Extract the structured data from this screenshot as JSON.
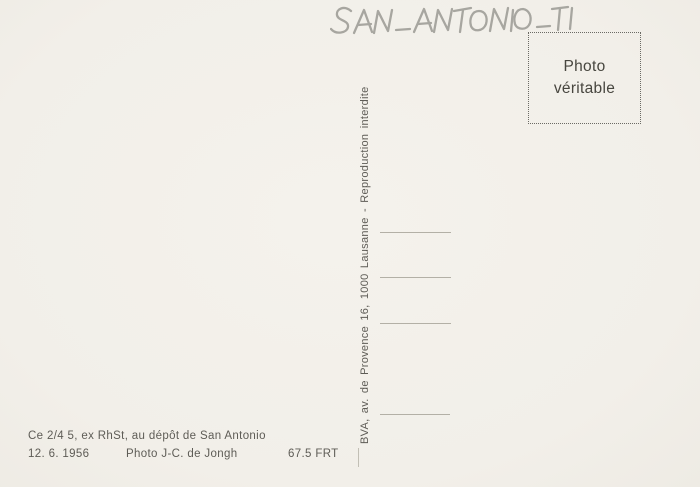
{
  "card": {
    "kind_label": "postcard back"
  },
  "handwriting": {
    "text": "SAN-ANTONIO-TI"
  },
  "stamp": {
    "line1": "Photo",
    "line2": "véritable"
  },
  "publisher": {
    "imprint": "BVA, av. de Provence 16, 1000 Lausanne - Reproduction interdite"
  },
  "caption": {
    "description": "Ce 2/4 5, ex RhSt, au dépôt de San Antonio",
    "date": "12. 6. 1956",
    "photographer": "Photo J-C. de Jongh",
    "reference": "67.5 FRT"
  },
  "address_lines": {
    "count": 4
  },
  "colors": {
    "paper": "#f2efe9",
    "ink": "#5e5c56",
    "ink-dark": "#47463f",
    "pencil": "#a1a09a",
    "rule": "#b3b0a6",
    "dots": "#6b6a64"
  }
}
